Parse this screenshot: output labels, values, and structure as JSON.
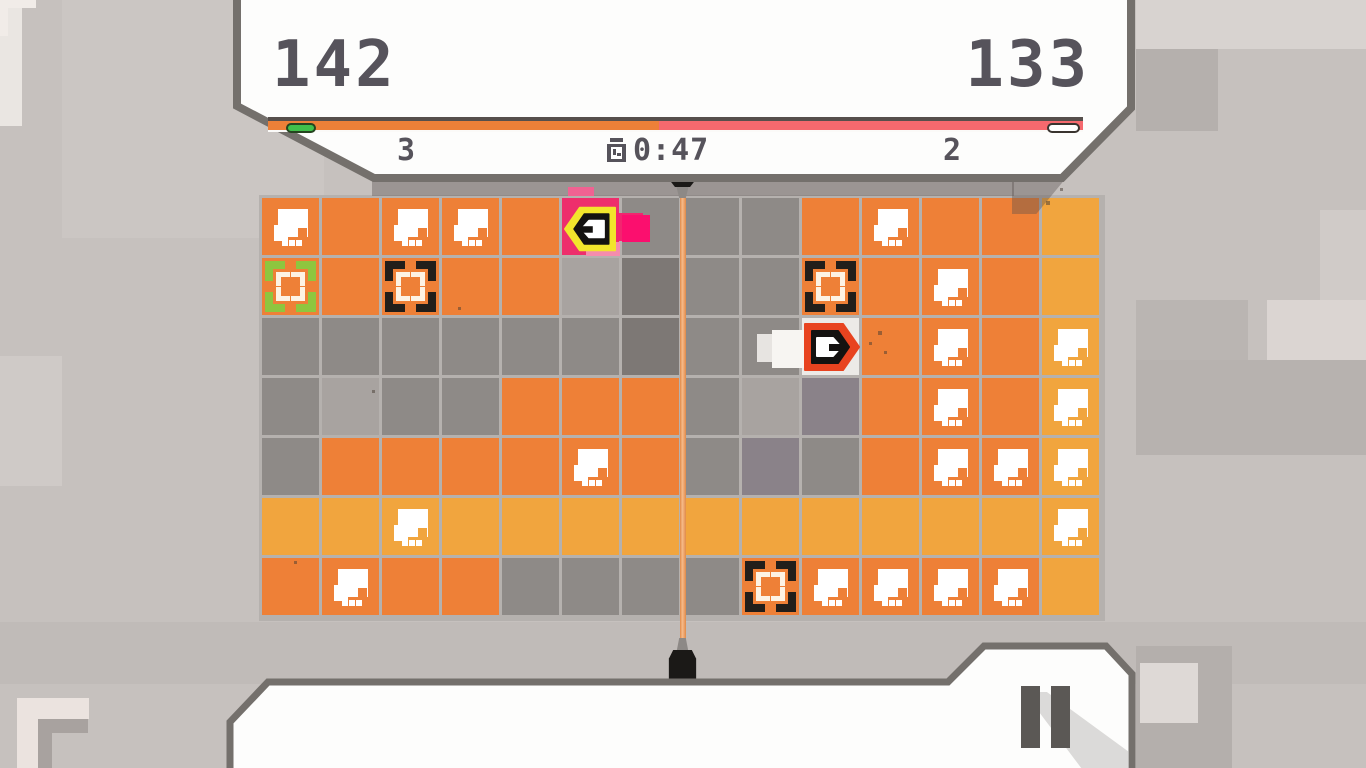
{
  "header": {
    "left_score": "142",
    "right_score": "133",
    "left_count": "3",
    "right_count": "2",
    "timer": "0:47",
    "bar": {
      "left_fill_pct": 48,
      "left_color": "#ed8038",
      "right_color": "#f5696e",
      "left_marker_color": "#41c04b",
      "right_marker_color": "#ffffff"
    }
  },
  "board": {
    "rows": 7,
    "cols": 14,
    "palette": {
      "o": "#ee8037",
      "a": "#f1a53e",
      "g": "#8e8a87",
      "d": "#7d7875",
      "l": "#a8a3a0",
      "p": "#8a8289",
      "w": "#eceae7",
      "k": "#ee2e6c"
    },
    "palette_names": {
      "o": "orange",
      "a": "amber",
      "g": "gray",
      "d": "dark-gray",
      "l": "light-gray",
      "p": "purple-gray",
      "w": "white",
      "k": "pink"
    },
    "cell_features": {
      "s": "skull-block",
      "bg": "green-target-brackets",
      "bb": "black-target-brackets"
    },
    "cells": [
      [
        "o:s",
        "o",
        "o:s",
        "o:s",
        "o",
        "k",
        "g",
        "g",
        "g",
        "o",
        "o:s",
        "o",
        "o",
        "a"
      ],
      [
        "o:bg",
        "o",
        "o:bb",
        "o",
        "o",
        "l",
        "d",
        "g",
        "g",
        "o:bb",
        "o",
        "o:s",
        "o",
        "a"
      ],
      [
        "g",
        "g",
        "g",
        "g",
        "g",
        "g",
        "d",
        "g",
        "g",
        "w",
        "o",
        "o:s",
        "o",
        "a:s"
      ],
      [
        "g",
        "l",
        "g",
        "g",
        "o",
        "o",
        "o",
        "g",
        "l",
        "p",
        "o",
        "o:s",
        "o",
        "a:s"
      ],
      [
        "g",
        "o",
        "o",
        "o",
        "o",
        "o:s",
        "o",
        "g",
        "p",
        "g",
        "o",
        "o:s",
        "o:s",
        "a:s"
      ],
      [
        "a",
        "a",
        "a:s",
        "a",
        "a",
        "a",
        "a",
        "a",
        "a",
        "a",
        "a",
        "a",
        "a",
        "a:s"
      ],
      [
        "o",
        "o:s",
        "o",
        "o",
        "g",
        "g",
        "g",
        "g",
        "o:bb",
        "o:s",
        "o:s",
        "o:s",
        "o:s",
        "a"
      ]
    ],
    "bracket_colors": {
      "green": "#8ec63f",
      "black": "#221e1a"
    }
  },
  "players": {
    "player1": {
      "color_name": "pink",
      "outline_color": "#f2e52c",
      "body_color": "#141210",
      "glyph_color": "#ffffff",
      "trail_color": "#fb0f6e",
      "facing": "left",
      "row": 1,
      "col": 6
    },
    "player2": {
      "color_name": "white",
      "outline_color": "#e8431f",
      "body_color": "#141210",
      "glyph_color": "#ffffff",
      "trail_color": "#f7f5f2",
      "facing": "right",
      "row": 3,
      "col": 10
    }
  },
  "divider": {
    "line_color": "#efa06a",
    "post_color": "#1b1917"
  },
  "pause": {
    "icon": "pause"
  }
}
